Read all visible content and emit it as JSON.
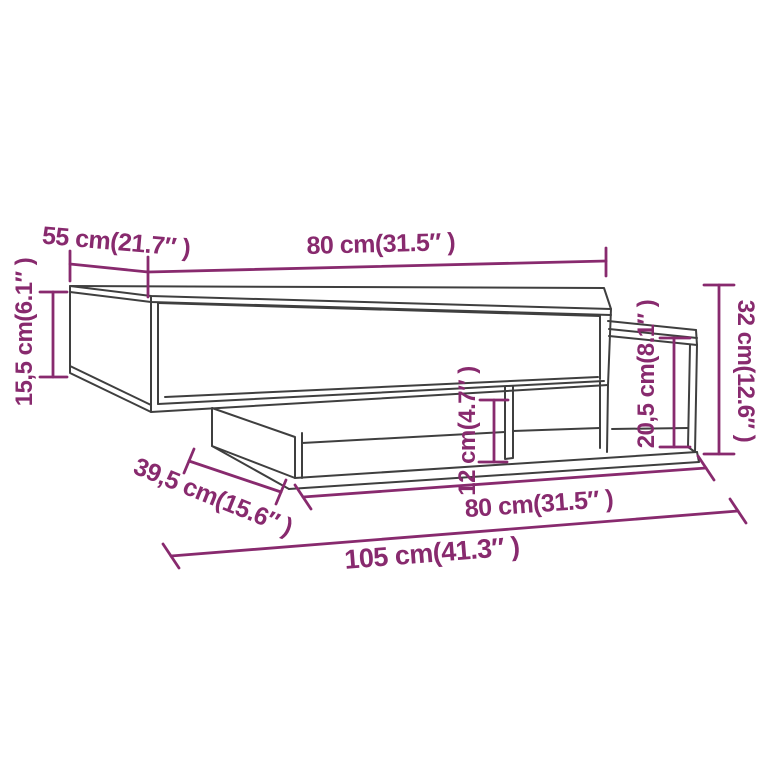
{
  "title": "Coffee table dimension diagram",
  "colors": {
    "dimension_accent": "#882a6e",
    "furniture_line": "#3f3f3f",
    "background": "#ffffff"
  },
  "dimensions": {
    "tabletop_depth": {
      "label": "55 cm(21.7″ )",
      "cm": "55",
      "inch": "21.7"
    },
    "tabletop_width": {
      "label": "80 cm(31.5″ )",
      "cm": "80",
      "inch": "31.5"
    },
    "tabletop_height": {
      "label": "15,5 cm(6.1″ )",
      "cm": "15,5",
      "inch": "6.1"
    },
    "overall_height": {
      "label": "32 cm(12.6″ )",
      "cm": "32",
      "inch": "12.6"
    },
    "side_unit_height": {
      "label": "20,5 cm(8.1″ )",
      "cm": "20,5",
      "inch": "8.1"
    },
    "shelf_opening_height": {
      "label": "12 cm(4.7″ )",
      "cm": "12",
      "inch": "4.7"
    },
    "base_depth": {
      "label": "39,5 cm(15.6″ )",
      "cm": "39,5",
      "inch": "15.6"
    },
    "base_width": {
      "label": "80 cm(31.5″ )",
      "cm": "80",
      "inch": "31.5"
    },
    "overall_width": {
      "label": "105 cm(41.3″ )",
      "cm": "105",
      "inch": "41.3"
    }
  }
}
